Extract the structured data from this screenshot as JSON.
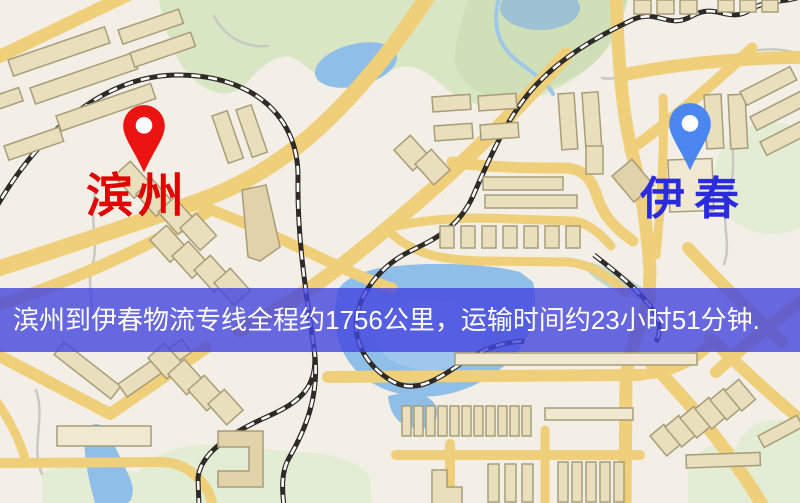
{
  "banner": {
    "text": "滨州到伊春物流专线全程约1756公里，运输时间约23小时51分钟.",
    "background": "#4445DFCC",
    "text_color": "#FFFFFF"
  },
  "origin": {
    "name": "滨州",
    "label_color": "#E00000",
    "pin_color": "#EC1410",
    "pin_icon": "map-pin"
  },
  "destination": {
    "name": "伊春",
    "label_color": "#2B2BDE",
    "pin_color": "#4C86F0",
    "pin_icon": "map-pin"
  },
  "map_palette": {
    "background": "#F3EFE6",
    "road": "#F0CF7A",
    "water": "#8FBEE8",
    "park": "#D9E6C4",
    "building": "#EADFBD",
    "building_outline": "#A79D79",
    "railway": "#2E2A28"
  }
}
